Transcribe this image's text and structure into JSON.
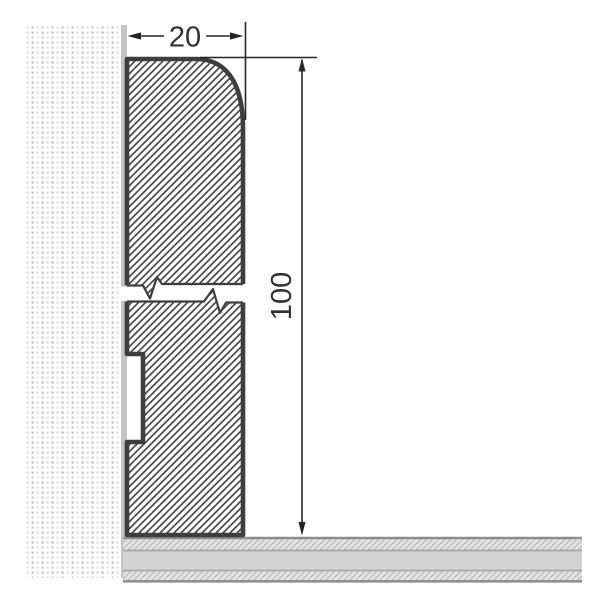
{
  "drawing": {
    "type": "skirting-board-cross-section",
    "dimensions": {
      "width_mm": "20",
      "height_mm": "100"
    },
    "colors": {
      "background": "#ffffff",
      "outline": "#3e3e3e",
      "hatch_line": "#4c4c4c",
      "dimension_line": "#262626",
      "dimension_text": "#303030",
      "wall_face_strip": "#c3c3c3",
      "wall_dot_a": "#bdbdbd",
      "wall_dot_b": "#dadada",
      "wall_dot_c": "#cccccc",
      "wall_dot_d": "#e4e4e4",
      "floor_solid": "#d3d3d3",
      "floor_hatch_bg": "#e3e3e3",
      "floor_hatch_line": "#b3b3b3",
      "floor_border_dark": "#8f8f8f",
      "floor_border_light": "#a3a3a3"
    }
  }
}
